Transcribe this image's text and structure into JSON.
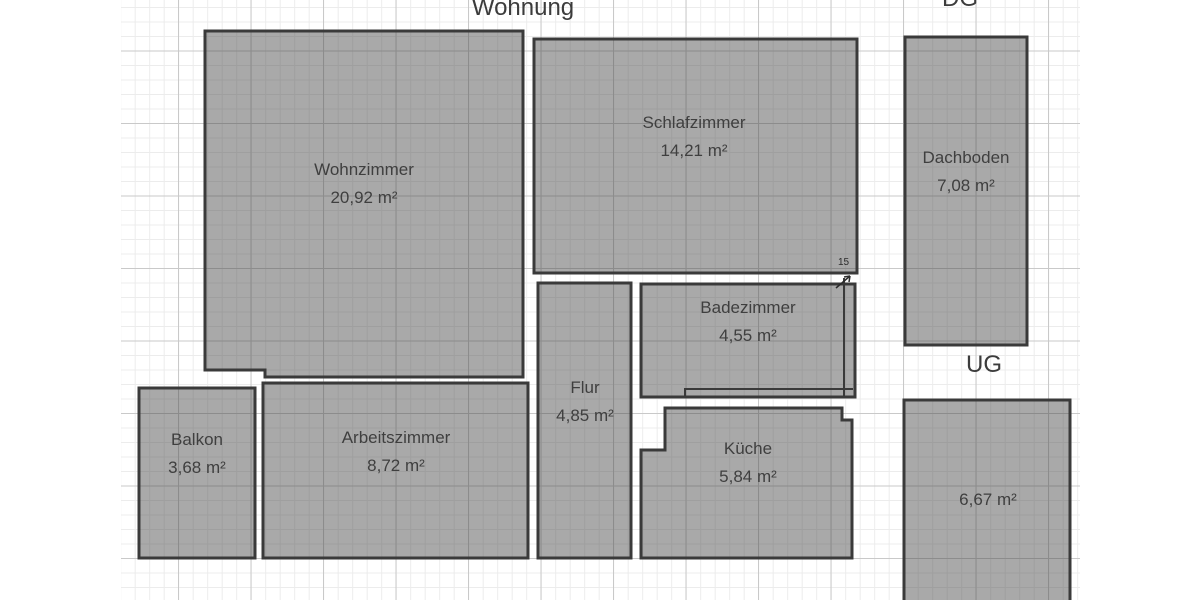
{
  "titles": {
    "apartment": "Wohnung",
    "attic_floor": "DG",
    "basement_floor": "UG"
  },
  "rooms": [
    {
      "name": "Wohnzimmer",
      "area": "20,92 m²"
    },
    {
      "name": "Schlafzimmer",
      "area": "14,21 m²"
    },
    {
      "name": "Dachboden",
      "area": "7,08 m²"
    },
    {
      "name": "Badezimmer",
      "area": "4,55 m²"
    },
    {
      "name": "Flur",
      "area": "4,85 m²"
    },
    {
      "name": "Balkon",
      "area": "3,68 m²"
    },
    {
      "name": "Arbeitszimmer",
      "area": "8,72 m²"
    },
    {
      "name": "Küche",
      "area": "5,84 m²"
    },
    {
      "area": "6,67 m²"
    }
  ],
  "annotations": {
    "wall_dimension": "15"
  },
  "colors": {
    "room_fill": "rgba(72,72,72,0.47)",
    "room_border": "#3a3a3a",
    "grid_minor": "#ececec",
    "grid_major": "#c9c9c9",
    "label_text": "#3f3f3f",
    "background": "#ffffff"
  }
}
